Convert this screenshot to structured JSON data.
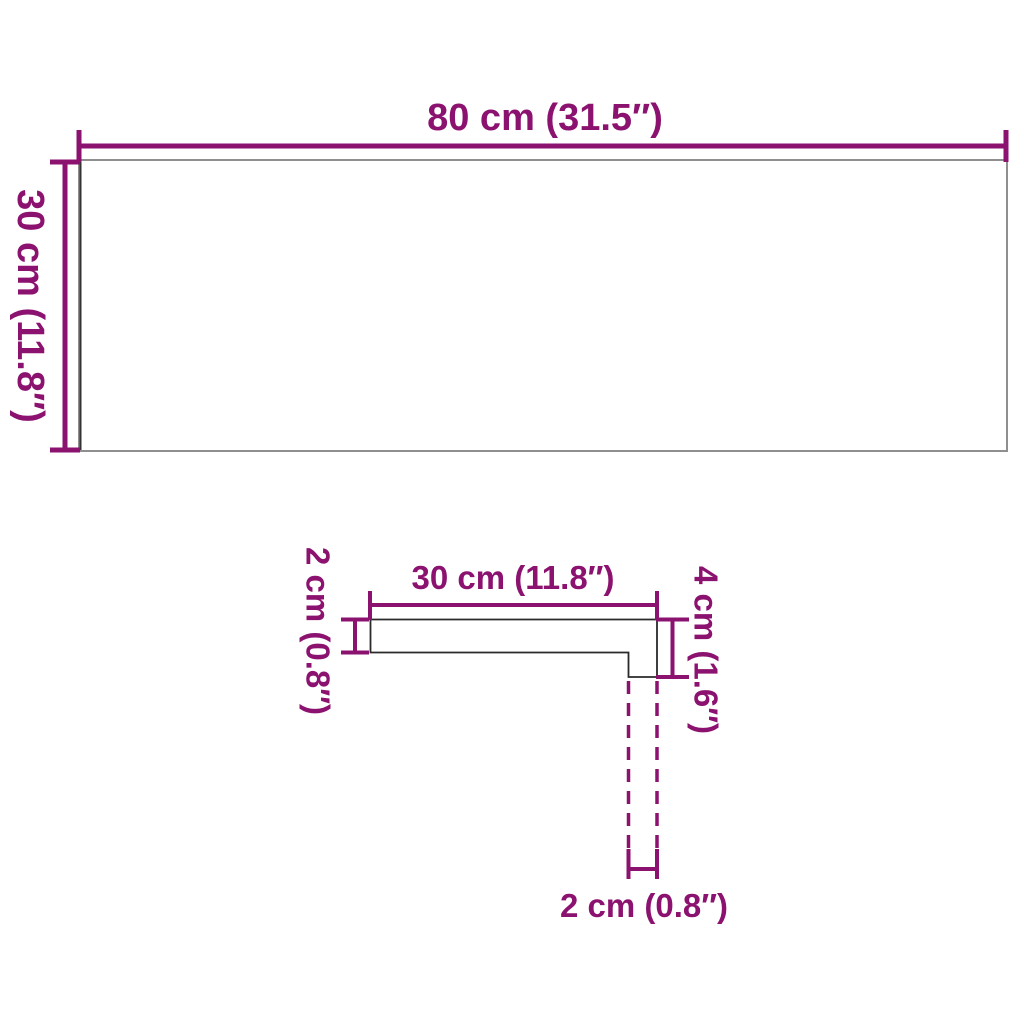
{
  "colors": {
    "accent": "#8c1270",
    "panel_outline": "#8f8f8f",
    "panel_left_edge": "#333333",
    "profile_outline": "#2a2a2a",
    "background": "#ffffff"
  },
  "top_view": {
    "width_label": "80 cm (31.5″)",
    "height_label": "30 cm (11.8″)"
  },
  "profile_view": {
    "width_label": "30 cm (11.8″)",
    "thickness_label": "2 cm (0.8″)",
    "edge_height_label": "4 cm (1.6″)",
    "nose_width_label": "2 cm (0.8″)"
  }
}
